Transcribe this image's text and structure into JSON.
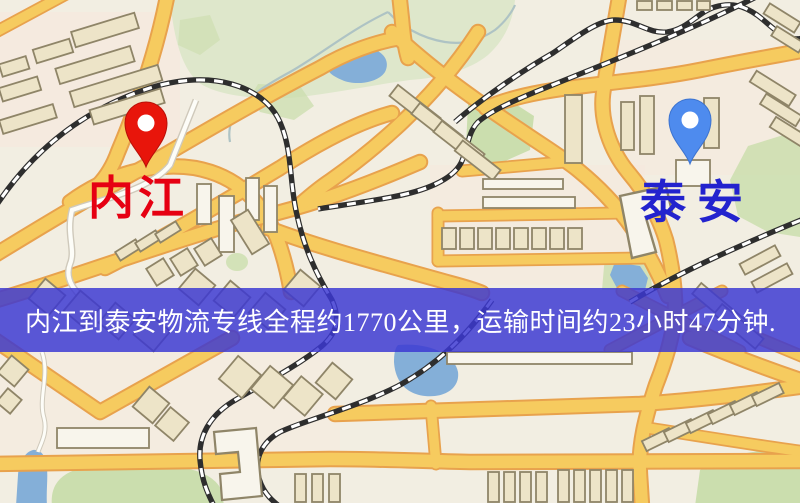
{
  "route": {
    "origin": {
      "name": "内江"
    },
    "destination": {
      "name": "泰安"
    },
    "banner_text": "内江到泰安物流专线全程约1770公里，运输时间约23小时47分钟."
  },
  "icons": {
    "origin_pin": "red-location-pin-icon",
    "destination_pin": "blue-location-pin-icon"
  },
  "colors": {
    "origin_pin": "#E8150B",
    "origin_label": "#E60012",
    "dest_pin": "#4E8BEE",
    "dest_label": "#2323CE",
    "banner_bg": "rgba(60,56,210,0.84)",
    "banner_text": "#FFFFFF",
    "map_bg": "#F2EEE2",
    "road_fill": "#F6CB5F",
    "road_casing": "#E8A24D",
    "building_fill": "#EDE4C8",
    "building_stroke": "#8F8568",
    "building_light": "#F8F5EC",
    "green_light": "#DEE7CB",
    "green_mid": "#CBDEAE",
    "water": "#84AFD8",
    "rail": "#2E2E2E",
    "stream": "#AEC3C4",
    "pink_zone": "#F8E7DC"
  }
}
